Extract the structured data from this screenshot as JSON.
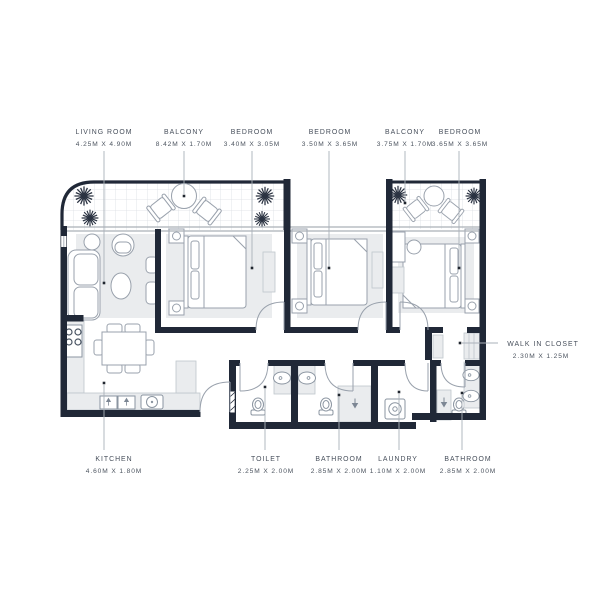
{
  "plan": {
    "title": "apartment-floor-plan",
    "rooms": [
      {
        "id": "living-room",
        "name": "LIVING ROOM",
        "dims": "4.25M X 4.90M"
      },
      {
        "id": "balcony-1",
        "name": "BALCONY",
        "dims": "8.42M X 1.70M"
      },
      {
        "id": "bedroom-1",
        "name": "BEDROOM",
        "dims": "3.40M X 3.05M"
      },
      {
        "id": "bedroom-2",
        "name": "BEDROOM",
        "dims": "3.50M X 3.65M"
      },
      {
        "id": "balcony-2",
        "name": "BALCONY",
        "dims": "3.75M X 1.70M"
      },
      {
        "id": "bedroom-3",
        "name": "BEDROOM",
        "dims": "3.65M X 3.65M"
      },
      {
        "id": "walk-in-closet",
        "name": "WALK IN CLOSET",
        "dims": "2.30M X 1.25M"
      },
      {
        "id": "kitchen",
        "name": "KITCHEN",
        "dims": "4.60M X 1.80M"
      },
      {
        "id": "toilet",
        "name": "TOILET",
        "dims": "2.25M X 2.00M"
      },
      {
        "id": "bathroom-1",
        "name": "BATHROOM",
        "dims": "2.85M X 2.00M"
      },
      {
        "id": "laundry",
        "name": "LAUNDRY",
        "dims": "1.10M X 2.00M"
      },
      {
        "id": "bathroom-2",
        "name": "BATHROOM",
        "dims": "2.85M X 2.00M"
      }
    ],
    "colors": {
      "wall": "#202837",
      "label_text": "#474f5b",
      "leader": "#aab1b9",
      "light_fill": "#eaecee",
      "tile_grid": "#dadee3",
      "furniture_line": "#99a1ac"
    }
  }
}
